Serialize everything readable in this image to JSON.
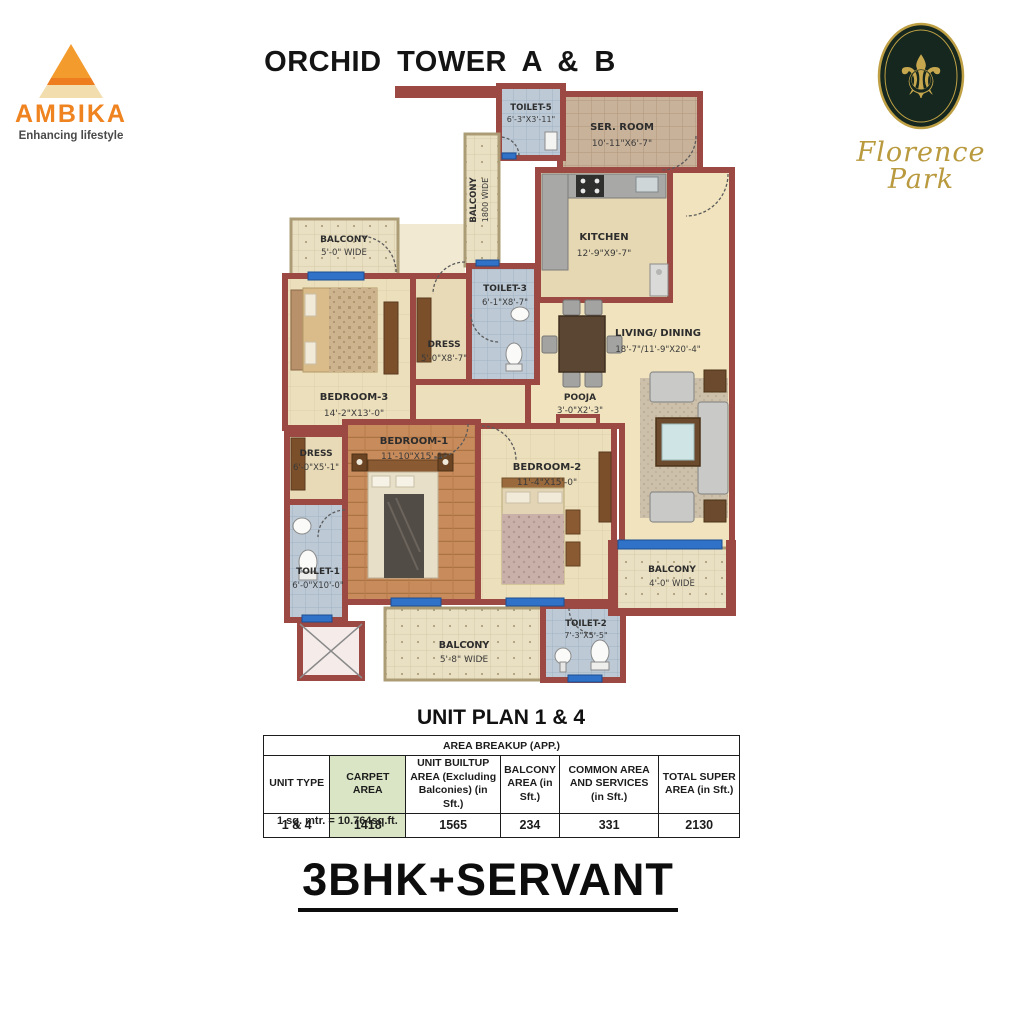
{
  "header": {
    "title": "ORCHID TOWER A & B",
    "ambika": {
      "name": "AMBIKA",
      "tagline": "Enhancing lifestyle",
      "brand_orange": "#ef8320"
    },
    "florence": {
      "name": "Florence Park",
      "gold": "#c0a246",
      "emblem": "fleur-de-lis"
    }
  },
  "plan": {
    "rooms": {
      "toilet5": {
        "name": "TOILET-5",
        "dims": "6'-3\"X3'-11\""
      },
      "ser_room": {
        "name": "SER. ROOM",
        "dims": "10'-11\"X6'-7\""
      },
      "balcony_side": {
        "name": "BALCONY",
        "dims": "1800 WIDE"
      },
      "kitchen": {
        "name": "KITCHEN",
        "dims": "12'-9\"X9'-7\""
      },
      "balcony_tl": {
        "name": "BALCONY",
        "dims": "5'-0\" WIDE"
      },
      "toilet3": {
        "name": "TOILET-3",
        "dims": "6'-1\"X8'-7\""
      },
      "dress3": {
        "name": "DRESS",
        "dims": "5'-0\"X8'-7\""
      },
      "bedroom3": {
        "name": "BEDROOM-3",
        "dims": "14'-2\"X13'-0\""
      },
      "living": {
        "name": "LIVING/ DINING",
        "dims": "18'-7\"/11'-9\"X20'-4\""
      },
      "pooja": {
        "name": "POOJA",
        "dims": "3'-0\"X2'-3\""
      },
      "bedroom1": {
        "name": "BEDROOM-1",
        "dims": "11'-10\"X15'-1\""
      },
      "bedroom2": {
        "name": "BEDROOM-2",
        "dims": "11'-4\"X15'-0\""
      },
      "dress1": {
        "name": "DRESS",
        "dims": "6'-0\"X5'-1\""
      },
      "toilet1": {
        "name": "TOILET-1",
        "dims": "6'-0\"X10'-0\""
      },
      "balcony_bottom": {
        "name": "BALCONY",
        "dims": "5'-8\" WIDE"
      },
      "toilet2": {
        "name": "TOILET-2",
        "dims": "7'-3\"X5'-5\""
      },
      "balcony_right": {
        "name": "BALCONY",
        "dims": "4'-0\" WIDE"
      }
    },
    "wall_color": "#9c4843",
    "window_color": "#2f72c8"
  },
  "unit_plan": {
    "title": "UNIT PLAN 1 & 4",
    "table": {
      "caption": "AREA BREAKUP (APP.)",
      "columns": [
        "UNIT  TYPE",
        "CARPET AREA",
        "UNIT BUILTUP AREA (Excluding Balconies) (in Sft.)",
        "BALCONY AREA (in Sft.)",
        "COMMON AREA AND SERVICES  (in Sft.)",
        "TOTAL SUPER AREA (in Sft.)"
      ],
      "row": [
        "1 & 4",
        "1418",
        "1565",
        "234",
        "331",
        "2130"
      ]
    },
    "note": "1 sq. mtr. = 10.764sq.ft."
  },
  "footer": {
    "plan_type": "3BHK+SERVANT"
  }
}
